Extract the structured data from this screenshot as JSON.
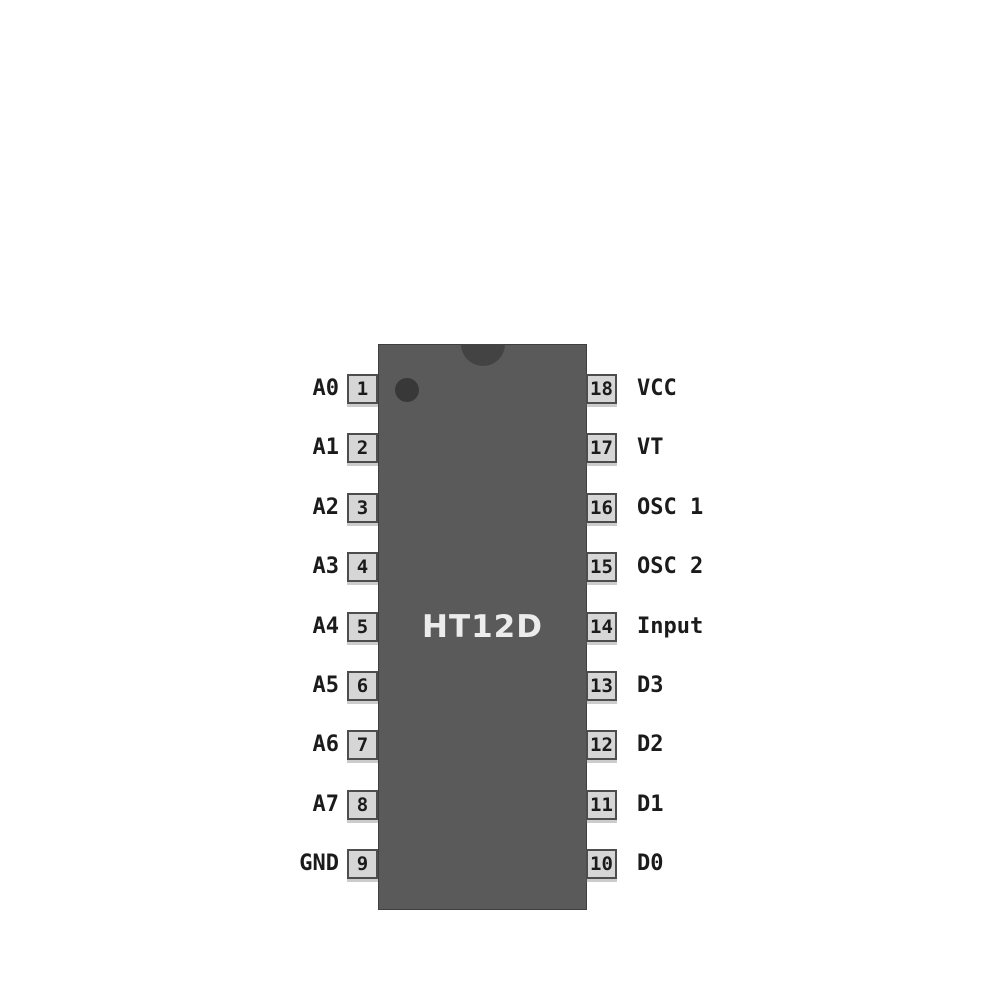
{
  "chip": {
    "label": "HT12D"
  },
  "pins": {
    "left": [
      {
        "name": "A0",
        "number": "1"
      },
      {
        "name": "A1",
        "number": "2"
      },
      {
        "name": "A2",
        "number": "3"
      },
      {
        "name": "A3",
        "number": "4"
      },
      {
        "name": "A4",
        "number": "5"
      },
      {
        "name": "A5",
        "number": "6"
      },
      {
        "name": "A6",
        "number": "7"
      },
      {
        "name": "A7",
        "number": "8"
      },
      {
        "name": "GND",
        "number": "9"
      }
    ],
    "right": [
      {
        "name": "VCC",
        "number": "18"
      },
      {
        "name": "VT",
        "number": "17"
      },
      {
        "name": "OSC 1",
        "number": "16"
      },
      {
        "name": "OSC 2",
        "number": "15"
      },
      {
        "name": "Input",
        "number": "14"
      },
      {
        "name": "D3",
        "number": "13"
      },
      {
        "name": "D2",
        "number": "12"
      },
      {
        "name": "D1",
        "number": "11"
      },
      {
        "name": "D0",
        "number": "10"
      }
    ]
  },
  "icons": {
    "notch": "top-orientation-notch",
    "pin1_dot": "pin-1-indicator-dot"
  },
  "colors": {
    "background": "#ffffff",
    "chip_body": "#5a5a5a",
    "chip_border": "#3f3f3f",
    "notch": "#434343",
    "pin1_dot": "#383838",
    "pin_box_fill": "#d6d6d6",
    "pin_box_border": "#4d4d4d",
    "pin_text": "#1b1b1b",
    "chip_label_text": "#ececec"
  }
}
